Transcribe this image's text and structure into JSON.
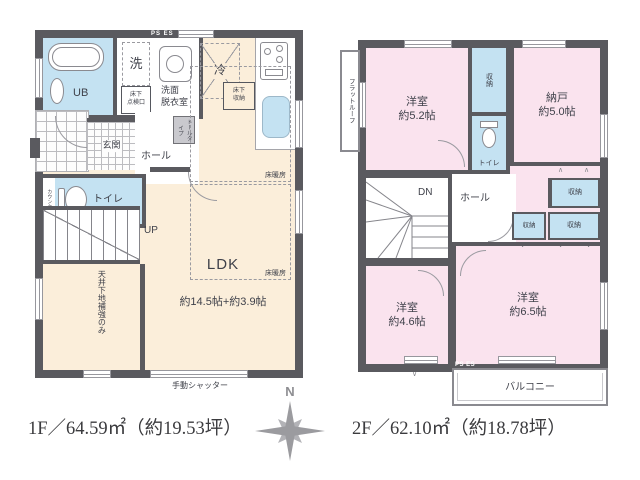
{
  "captions": {
    "floor1": "1F／64.59㎡（約19.53坪）",
    "floor2": "2F／62.10㎡（約18.78坪）"
  },
  "compass": {
    "north_label": "N"
  },
  "floor1": {
    "ub": "UB",
    "washer": "洗",
    "washroom": "洗面\n脱衣室",
    "inspection_hatch": "床下\n点検口",
    "ps_es": "PS ES",
    "fridge": "冷",
    "underfloor_storage": "床下\n収納",
    "entrance": "玄関",
    "hall": "ホール",
    "tall_cabinet": "トールタイプ",
    "counter": "カウンター",
    "toilet": "トイレ",
    "stairs_up": "UP",
    "ldk_name": "LDK",
    "ldk_size": "約14.5帖+約3.9帖",
    "floor_heating": "床暖房",
    "ceiling_note": "天井下地補強のみ",
    "shutter": "手動シャッター"
  },
  "floor2": {
    "flat_roof": "フラットルーフ",
    "bedroom_a_name": "洋室",
    "bedroom_a_size": "約5.2帖",
    "storeroom_name": "納戸",
    "storeroom_size": "約5.0帖",
    "closet": "収納",
    "toilet": "トイレ",
    "stairs_down": "DN",
    "hall": "ホール",
    "bedroom_b_name": "洋室",
    "bedroom_b_size": "約4.6帖",
    "bedroom_c_name": "洋室",
    "bedroom_c_size": "約6.5帖",
    "balcony": "バルコニー",
    "ps_es": "PS ES"
  },
  "colors": {
    "wall": "#5a5a5f",
    "floor_beige": "#fbeeda",
    "room_pink": "#fae3ee",
    "room_blue": "#c4e2f2"
  }
}
